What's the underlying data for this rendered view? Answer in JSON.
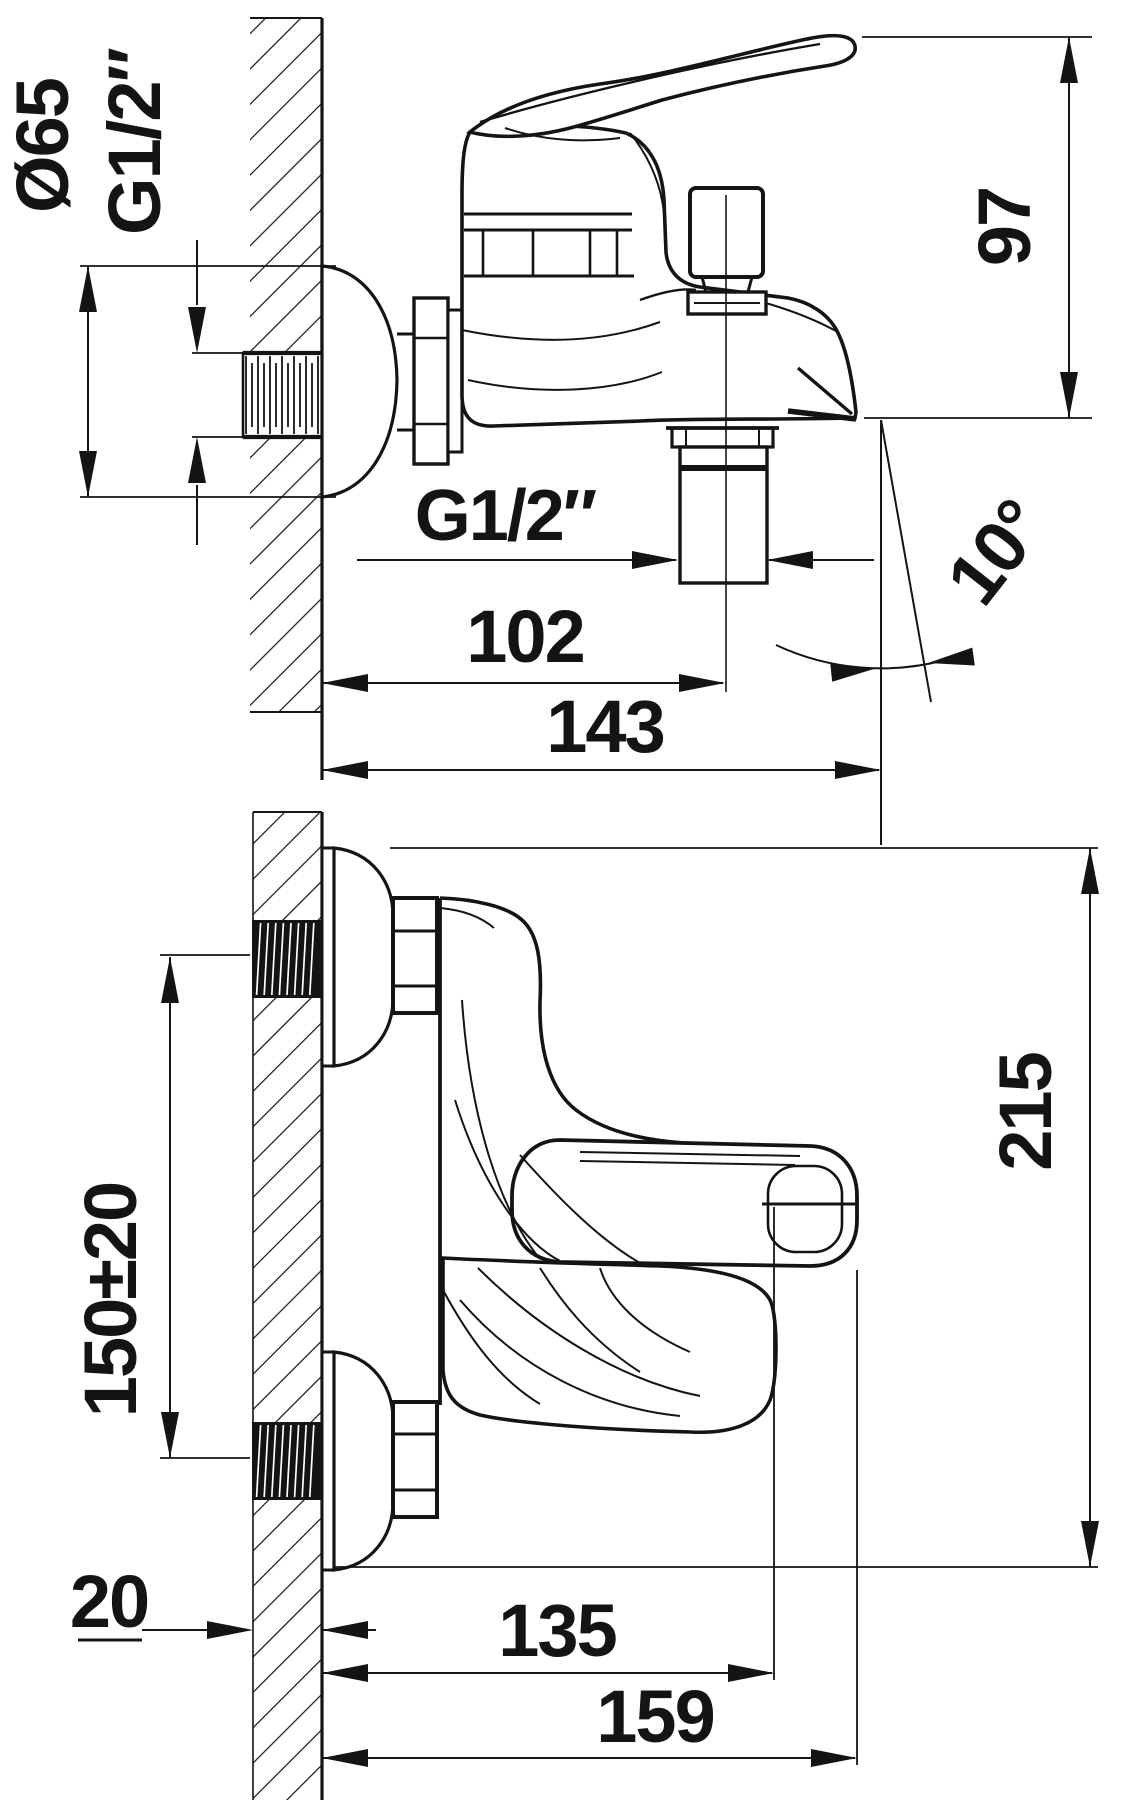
{
  "drawing": {
    "type": "technical-installation-drawing",
    "product": "wall-mounted bath mixer",
    "line_color": "#141414",
    "background": "#ffffff",
    "side_view": {
      "dims": {
        "flange_diameter": "Ø65",
        "wall_thread": "G1/2″",
        "spout_height": "97",
        "hose_thread": "G1/2″",
        "hose_center_offset": "102",
        "overall_reach": "143",
        "spout_angle": "10°"
      }
    },
    "front_view": {
      "dims": {
        "inlet_spacing": "150±20",
        "wall_thickness": "20",
        "spout_width": "135",
        "overall_width": "159",
        "overall_height": "215"
      }
    }
  }
}
